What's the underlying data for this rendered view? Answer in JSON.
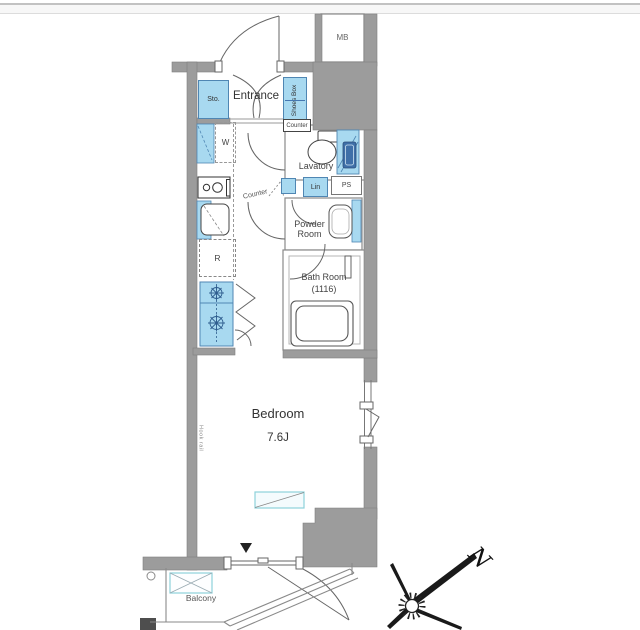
{
  "plan": {
    "labels": {
      "entrance": "Entrance",
      "storage": "Sto.",
      "shoes_box": "Shoes Box",
      "washer": "W",
      "counter_upper": "Counter",
      "lavatory": "Lavatory",
      "counter_mid": "Counter",
      "linen": "Lin",
      "pipe_space": "PS",
      "powder_room": "Powder Room",
      "bath_room": "Bath Room",
      "bath_room_size": "(1116)",
      "refrigerator": "R",
      "bedroom": "Bedroom",
      "bedroom_size": "7.6J",
      "balcony": "Balcony",
      "meter_box": "MB",
      "hook_rail": "Hook rail"
    },
    "compass": {
      "north": "N"
    },
    "colors": {
      "wall_gray": "#9c9c9c",
      "fixture_blue": "#a8d9f0",
      "fixture_blue_dark": "#4577b0",
      "counter_teal": "#8ed1da",
      "line_dark": "#555555"
    }
  }
}
